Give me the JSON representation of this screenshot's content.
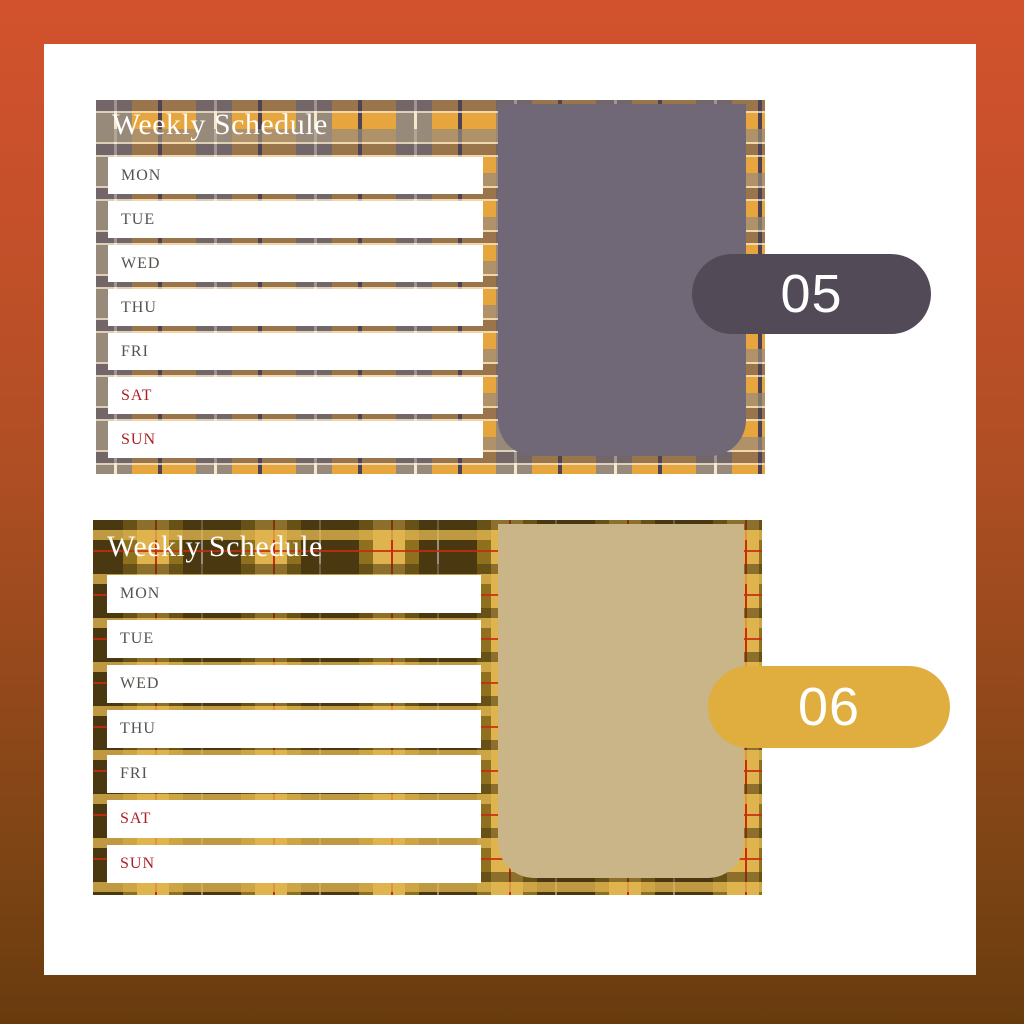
{
  "background": {
    "gradient_top": "#D2522D",
    "gradient_bottom": "#683B0E",
    "card_color": "#FFFFFF"
  },
  "planners": [
    {
      "title": "Weekly Schedule",
      "title_color": "#FFFFFF",
      "days": [
        "MON",
        "TUE",
        "WED",
        "THU",
        "FRI",
        "SAT",
        "SUN"
      ],
      "weekday_color": "#56524E",
      "weekend_color": "#AC1F24",
      "notes_color": "#706877",
      "badge": {
        "label": "05",
        "color": "#534A58",
        "text_color": "#FFFFFF"
      },
      "plaid_palette": {
        "base_orange": "#E7A53E",
        "stripe_taupe": "#978A7B",
        "stripe_purple": "#4D4355",
        "pinstripe_cream": "#F4E8CE"
      }
    },
    {
      "title": "Weekly Schedule",
      "title_color": "#FFFFFF",
      "days": [
        "MON",
        "TUE",
        "WED",
        "THU",
        "FRI",
        "SAT",
        "SUN"
      ],
      "weekday_color": "#56524E",
      "weekend_color": "#AC1F24",
      "notes_color": "#C9B587",
      "badge": {
        "label": "06",
        "color": "#DFAE3E",
        "text_color": "#FFFFFF"
      },
      "plaid_palette": {
        "base_olive": "#8E701E",
        "stripe_dark_brown": "#4A3811",
        "stripe_gold": "#DFB44F",
        "pinstripe_red": "#C62C0E",
        "pinstripe_gray": "#98907C",
        "pinstripe_cream": "#EFE3C0"
      }
    }
  ]
}
